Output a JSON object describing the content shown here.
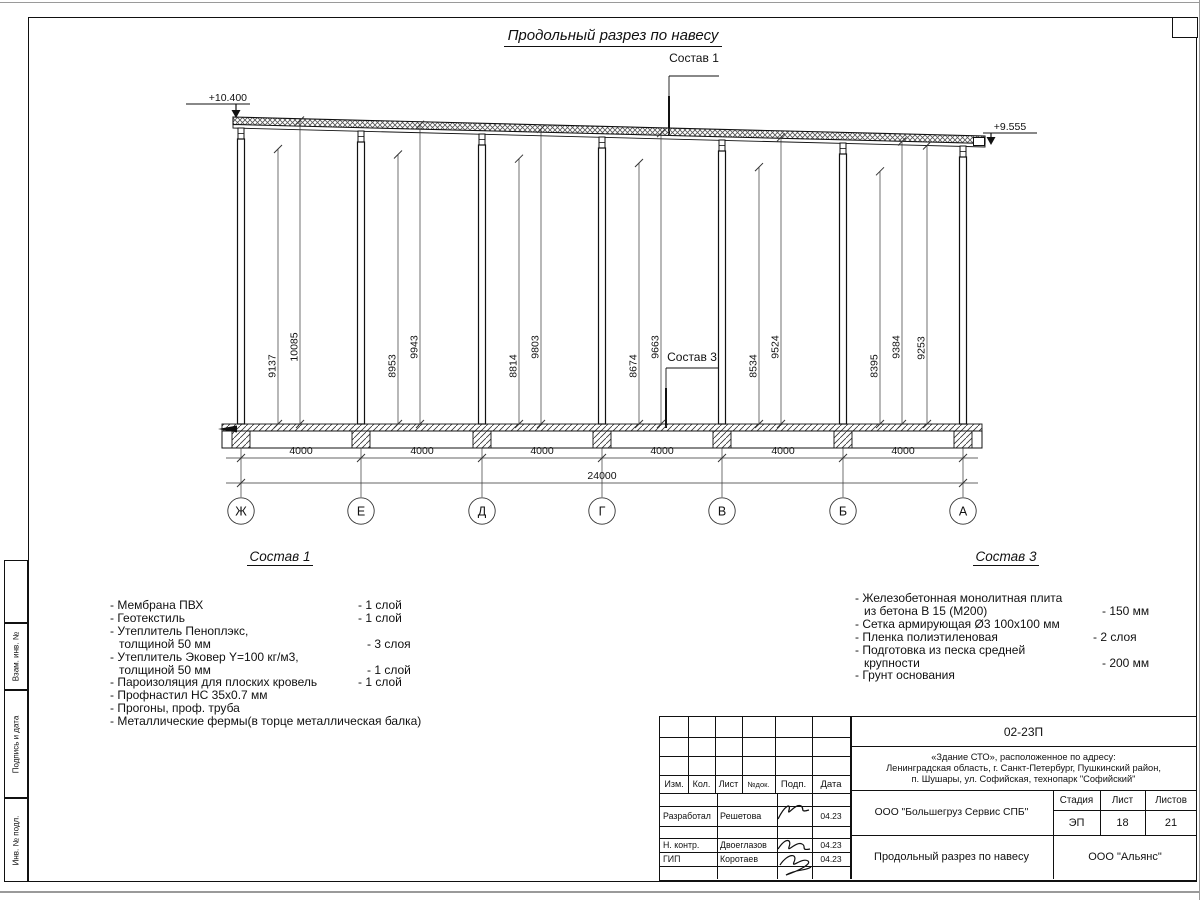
{
  "drawing": {
    "title": "Продольный разрез по навесу",
    "callout_top": "Состав 1",
    "callout_slab": "Состав 3",
    "elev_left": "+10.400",
    "elev_right": "+9.555",
    "heights": [
      [
        "9137",
        "10085"
      ],
      [
        "8953",
        "9943"
      ],
      [
        "8814",
        "9803"
      ],
      [
        "8674",
        "9663"
      ],
      [
        "8534",
        "9524"
      ],
      [
        "8395",
        "9384"
      ]
    ],
    "height_end": "9253",
    "spans": [
      "4000",
      "4000",
      "4000",
      "4000",
      "4000",
      "4000"
    ],
    "total_span": "24000",
    "axes": [
      "Ж",
      "Е",
      "Д",
      "Г",
      "В",
      "Б",
      "А"
    ]
  },
  "sostav1": {
    "heading": "Состав 1",
    "rows": [
      {
        "t": "- Мембрана ПВХ",
        "q": "- 1 слой"
      },
      {
        "t": "- Геотекстиль",
        "q": "- 1 слой"
      },
      {
        "t": "- Утеплитель Пеноплэкс,",
        "q": ""
      },
      {
        "t": "толщиной 50 мм",
        "q": "- 3 слоя"
      },
      {
        "t": "- Утеплитель Эковер Y=100 кг/м3,",
        "q": ""
      },
      {
        "t": "толщиной 50 мм",
        "q": "- 1 слой"
      },
      {
        "t": "- Пароизоляция для плоских кровель",
        "q": "- 1 слой"
      },
      {
        "t": "- Профнастил НС 35х0.7 мм",
        "q": ""
      },
      {
        "t": "- Прогоны, проф. труба",
        "q": ""
      },
      {
        "t": "- Металлические фермы(в торце металлическая балка)",
        "q": ""
      }
    ]
  },
  "sostav3": {
    "heading": "Состав 3",
    "rows": [
      {
        "t": "- Железобетонная  монолитная плита",
        "q": ""
      },
      {
        "t": "из бетона В 15 (М200)",
        "q": "- 150 мм"
      },
      {
        "t": "- Сетка армирующая Ø3 100x100 мм",
        "q": ""
      },
      {
        "t": "- Пленка полиэтиленовая",
        "q": "-  2 слоя"
      },
      {
        "t": "- Подготовка из песка средней",
        "q": ""
      },
      {
        "t": "крупности",
        "q": "- 200 мм"
      },
      {
        "t": "- Грунт основания",
        "q": ""
      }
    ]
  },
  "titleblock": {
    "code": "02-23П",
    "object_line1": "«Здание СТО», расположенное по адресу:",
    "object_line2": "Ленинградская область, г. Санкт-Петербург, Пушкинский район,",
    "object_line3": "п. Шушары, ул. Софийская, технопарк \"Софийский\"",
    "col_izm": "Изм.",
    "col_kol": "Кол.",
    "col_list": "Лист",
    "col_ndok": "№док.",
    "col_podp": "Подп.",
    "col_data": "Дата",
    "row1_role": "Разработал",
    "row1_name": "Решетова",
    "row1_date": "04.23",
    "row2_role": "Н. контр.",
    "row2_name": "Двоеглазов",
    "row2_date": "04.23",
    "row3_role": "ГИП",
    "row3_name": "Коротаев",
    "row3_date": "04.23",
    "company": "ООО \"Большегруз Сервис СПБ\"",
    "stage_label": "Стадия",
    "stage_value": "ЭП",
    "sheet_label": "Лист",
    "sheet_value": "18",
    "sheets_label": "Листов",
    "sheets_value": "21",
    "doc_title": "Продольный разрез по навесу",
    "org": "ООО \"Альянс\""
  },
  "margin_stamps": {
    "vzam": "Взам. инв. №",
    "podpis": "Подпись и дата",
    "inv": "Инв. № подл."
  }
}
